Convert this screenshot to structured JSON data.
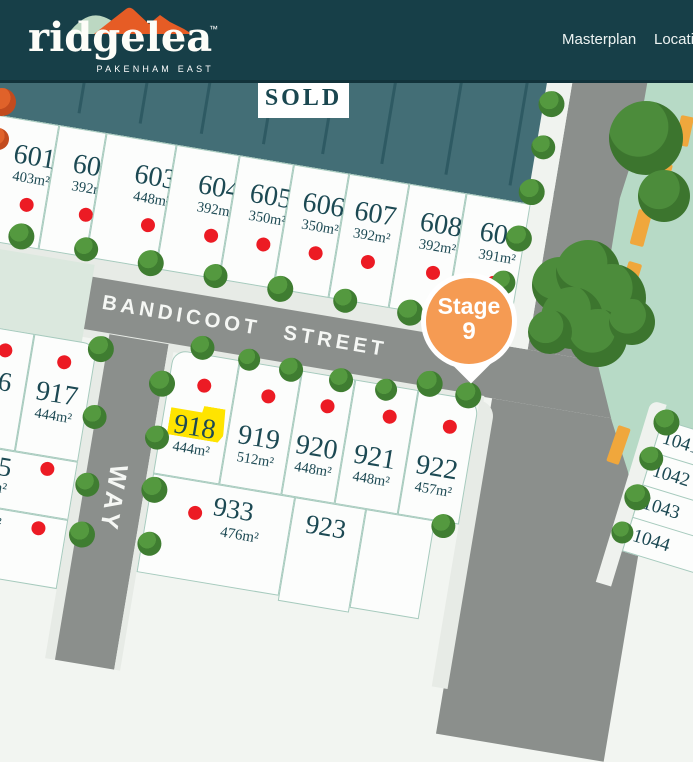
{
  "header": {
    "brand": {
      "name": "ridgelea",
      "tm": "™",
      "tagline": "PAKENHAM EAST"
    },
    "nav": [
      {
        "label": "Masterplan"
      },
      {
        "label": "Location"
      }
    ]
  },
  "map": {
    "sold_sign_label": "SOLD",
    "street_name": "BANDICOOT STREET",
    "way_road_label": "WAY",
    "stage_pin": {
      "line1": "Stage",
      "line2": "9"
    },
    "highlighted_lot_id": "918",
    "top_lots": [
      {
        "id": "601",
        "area": "403m²"
      },
      {
        "id": "602",
        "area": "392m²"
      },
      {
        "id": "603",
        "area": "448m²"
      },
      {
        "id": "604",
        "area": "392m²"
      },
      {
        "id": "605",
        "area": "350m²"
      },
      {
        "id": "606",
        "area": "350m²"
      },
      {
        "id": "607",
        "area": "392m²"
      },
      {
        "id": "608",
        "area": "392m²"
      },
      {
        "id": "609",
        "area": "391m²"
      }
    ],
    "left_lots": [
      {
        "id": "917",
        "area": "444m²"
      }
    ],
    "left_partial_lots": [
      {
        "id_fragment": "6",
        "area_fragment": "m²"
      },
      {
        "id_fragment": "5",
        "area_fragment": "m²"
      },
      {
        "id_fragment": "",
        "area_fragment": "²"
      }
    ],
    "lower_lots": [
      {
        "id": "918",
        "area": "444m²"
      },
      {
        "id": "919",
        "area": "512m²"
      },
      {
        "id": "920",
        "area": "448m²"
      },
      {
        "id": "921",
        "area": "448m²"
      },
      {
        "id": "922",
        "area": "457m²"
      }
    ],
    "bottom_lots": [
      {
        "id": "933",
        "area": "476m²"
      },
      {
        "id": "923",
        "area": ""
      }
    ],
    "right_lots": [
      {
        "id": "1041"
      },
      {
        "id": "1042"
      },
      {
        "id": "1043"
      },
      {
        "id": "1044"
      }
    ],
    "colors": {
      "header_teal": "#173F48",
      "sold_lot_fill": "#436E76",
      "sold_dot": "#EC1B24",
      "lot_highlight": "#FFE400",
      "stage_orange": "#F59B53",
      "road_gray": "#8B8F8C",
      "median_mint": "#B7DAC6",
      "dash_orange": "#F0A73C"
    }
  }
}
